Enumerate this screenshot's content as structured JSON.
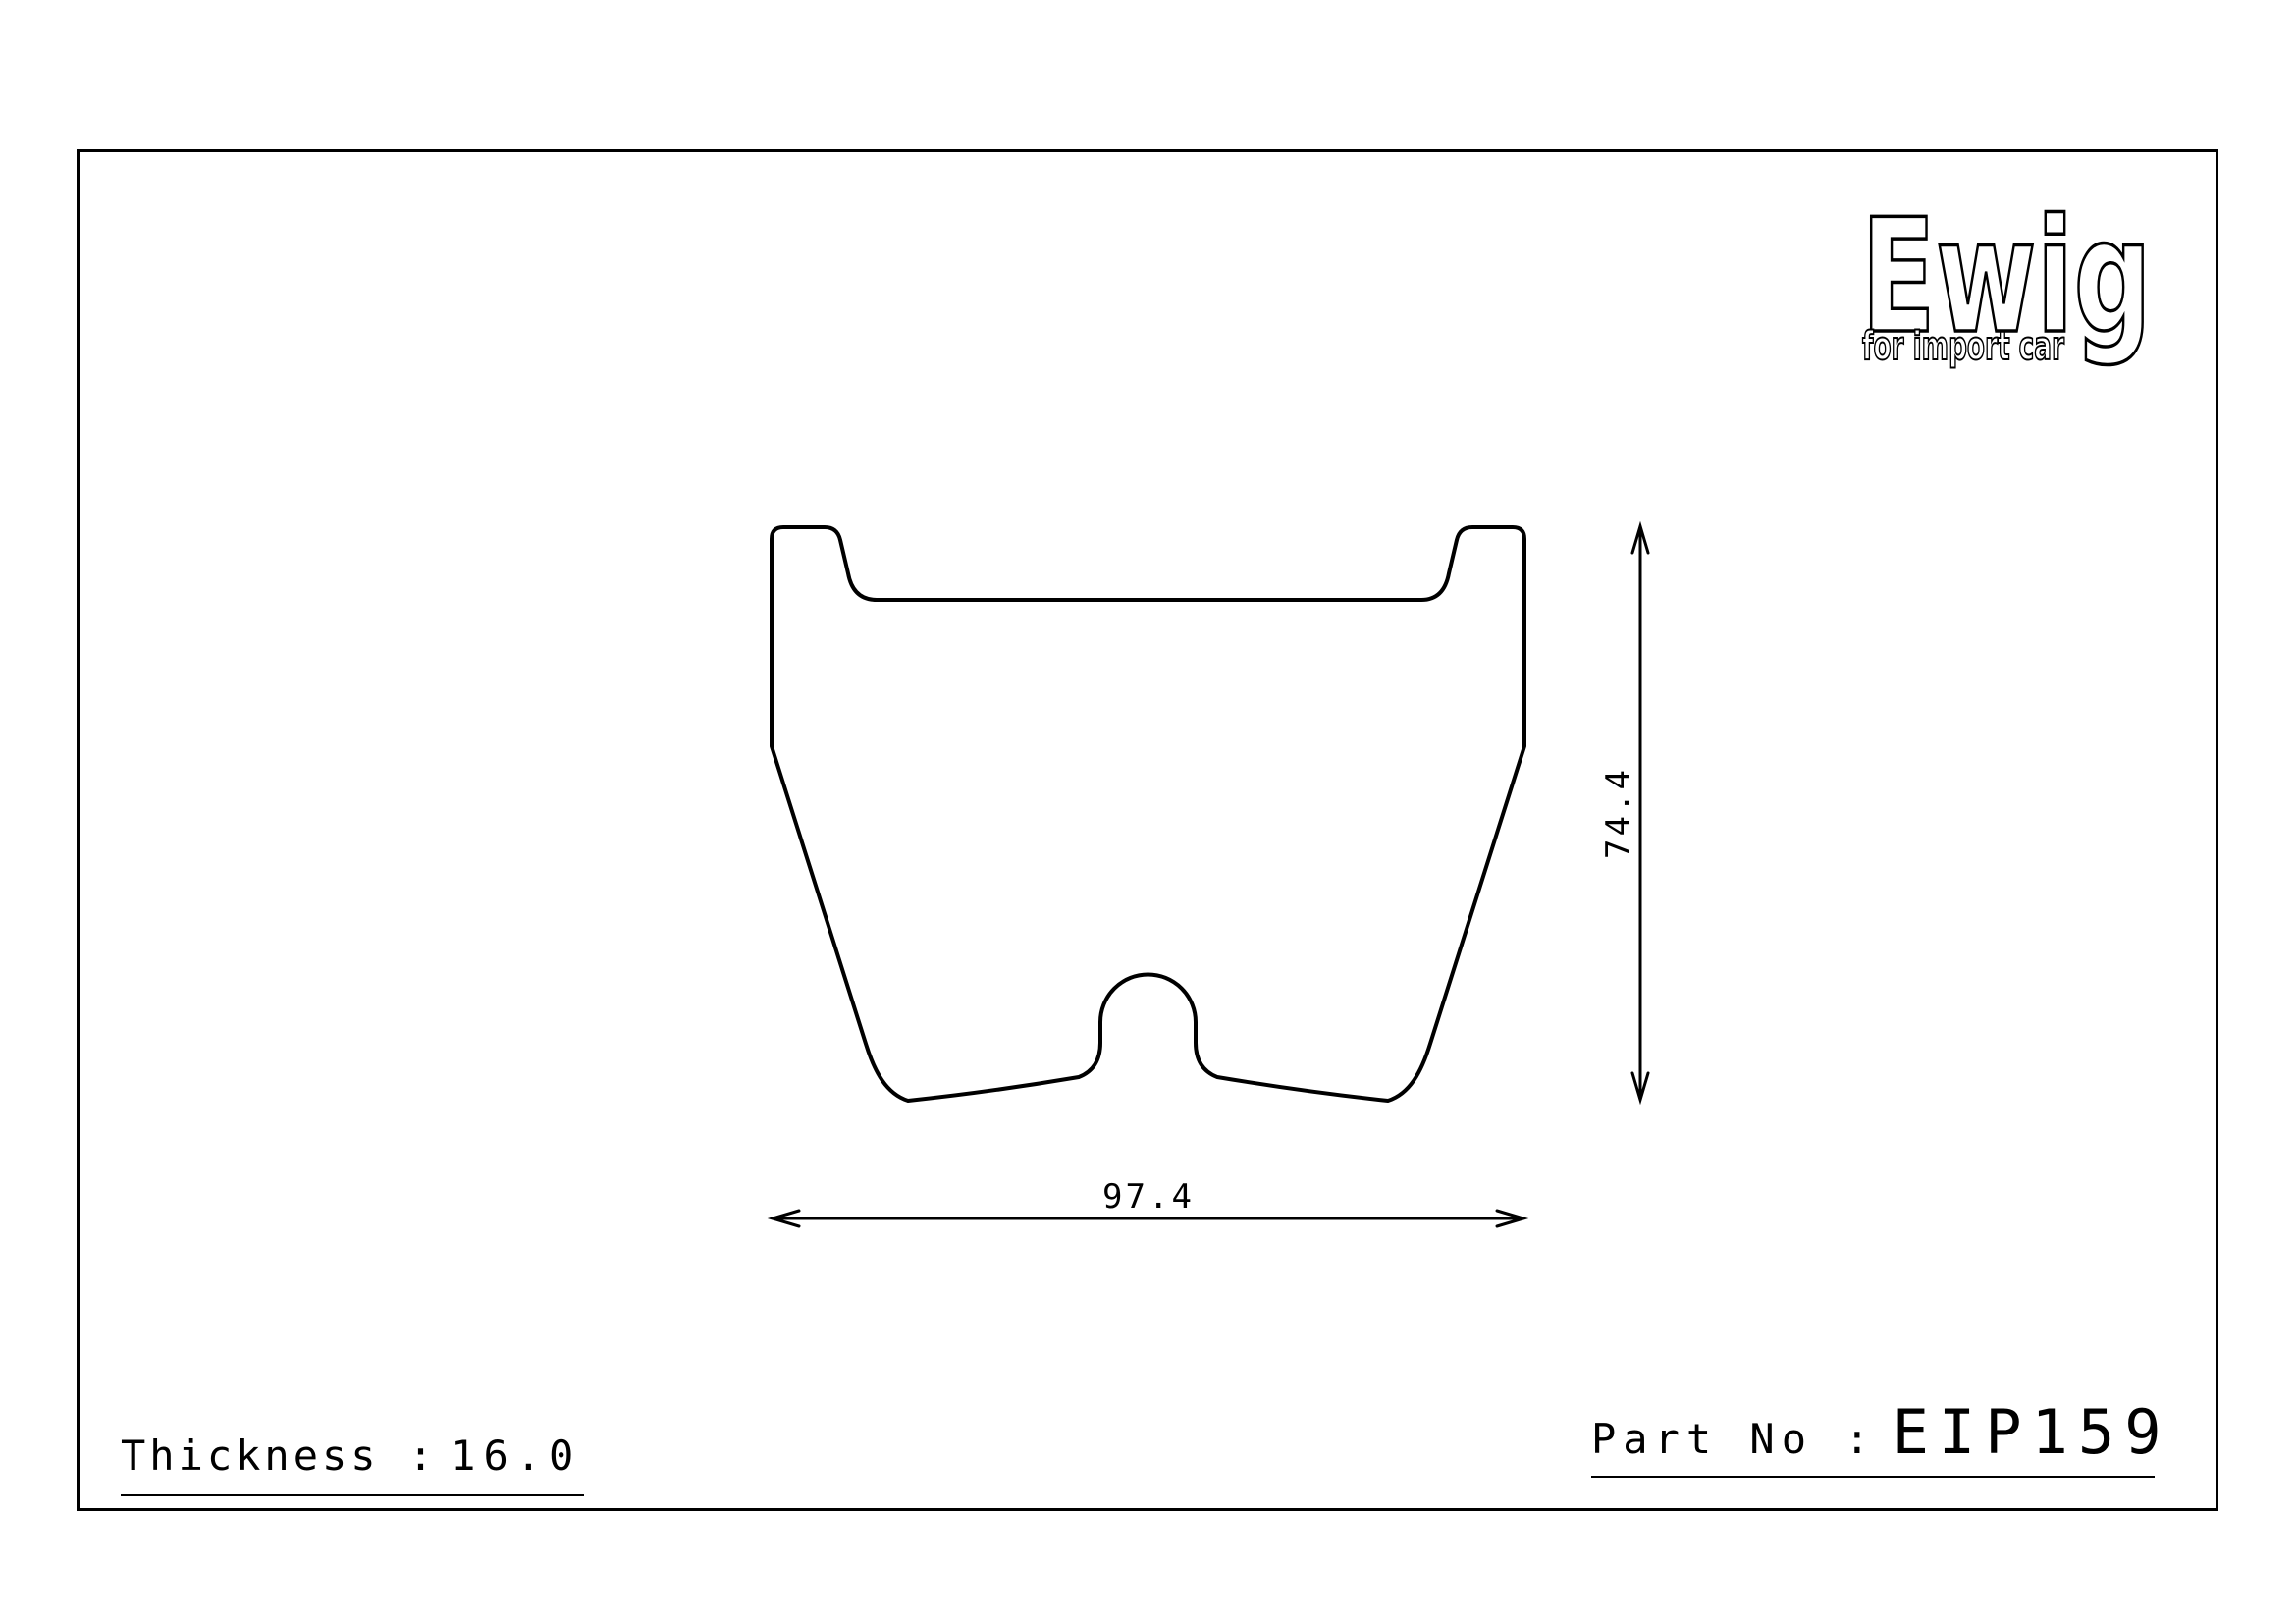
{
  "logo": {
    "brand": "Ewig",
    "tagline": "for import car"
  },
  "drawing": {
    "type": "brake-pad-outline-technical-drawing",
    "width_dim_mm": "97.4",
    "height_dim_mm": "74.4"
  },
  "footer": {
    "thickness_label": "Thickness :",
    "thickness_value": "16.0",
    "part_label": "Part No :",
    "part_value": "EIP159"
  },
  "colors": {
    "line": "#000000",
    "background": "#ffffff"
  }
}
